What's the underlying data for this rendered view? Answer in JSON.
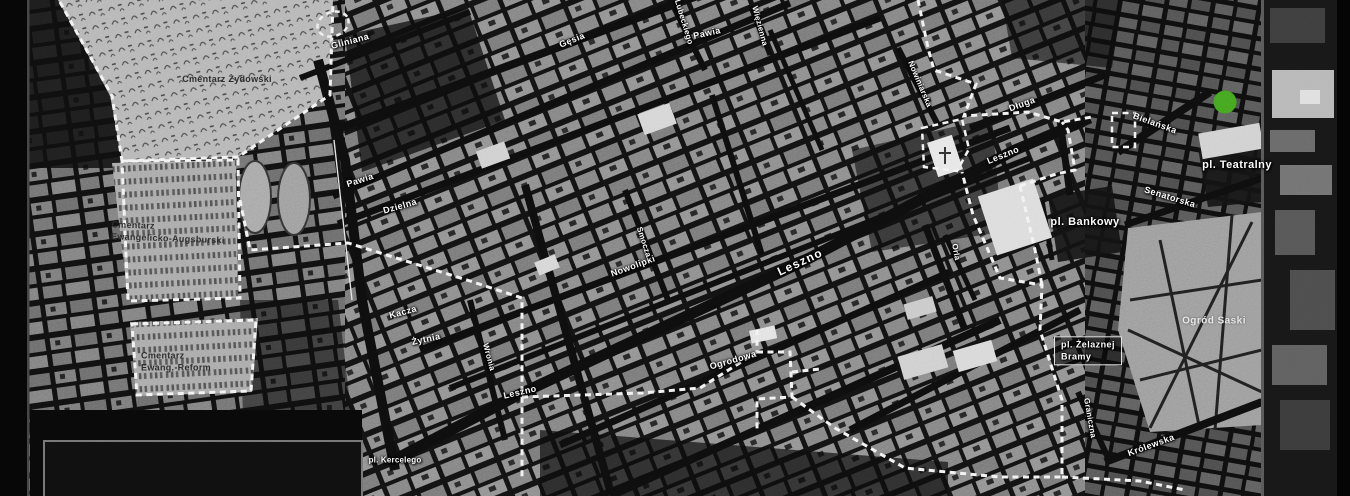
{
  "map": {
    "type": "historical-city-map",
    "theme": "dark-grayscale",
    "boundary_style": "white-dashed",
    "marker": {
      "name": "location-marker",
      "color": "#43a41f"
    }
  },
  "labels": {
    "cmentarz_zydowski": "Cmentarz Żydowski",
    "cmentarz_ewangelicki_line1": "Cmentarz",
    "cmentarz_ewangelicki_line2": "Ewangelicko-Augsburski",
    "cmentarz_reform_line1": "Cmentarz",
    "cmentarz_reform_line2": "Ewang.-Reform",
    "gliniana": "Gliniana",
    "gesia": "Gęsia",
    "lubeckiego": "Lubeckiego",
    "wiezienna": "Więzienna",
    "pawia_east": "Pawia",
    "pawia_west": "Pawia",
    "dzielna": "Dzielna",
    "nowolipki": "Nowolipki",
    "smocza": "Smocza",
    "kacza": "Kacza",
    "zytnia": "Żytnia",
    "wronia": "Wronia",
    "leszno_west": "Leszno",
    "leszno_center": "Leszno",
    "leszno_east": "Leszno",
    "ogrodowa": "Ogrodowa",
    "pl_kercelego": "pl. Kercelego",
    "nowiniarska": "Nowiniarska",
    "dluga": "Długa",
    "bielanska": "Bielańska",
    "pl_teatralny": "pl. Teatralny",
    "senatorska": "Senatorska",
    "pl_bankowy": "pl. Bankowy",
    "pl_zelaznej_line1": "pl. Żelaznej",
    "pl_zelaznej_line2": "Bramy",
    "ogrod_saski": "Ogród Saski",
    "graniczna": "Graniczna",
    "krolewska": "Królewska",
    "orla": "Orla"
  }
}
